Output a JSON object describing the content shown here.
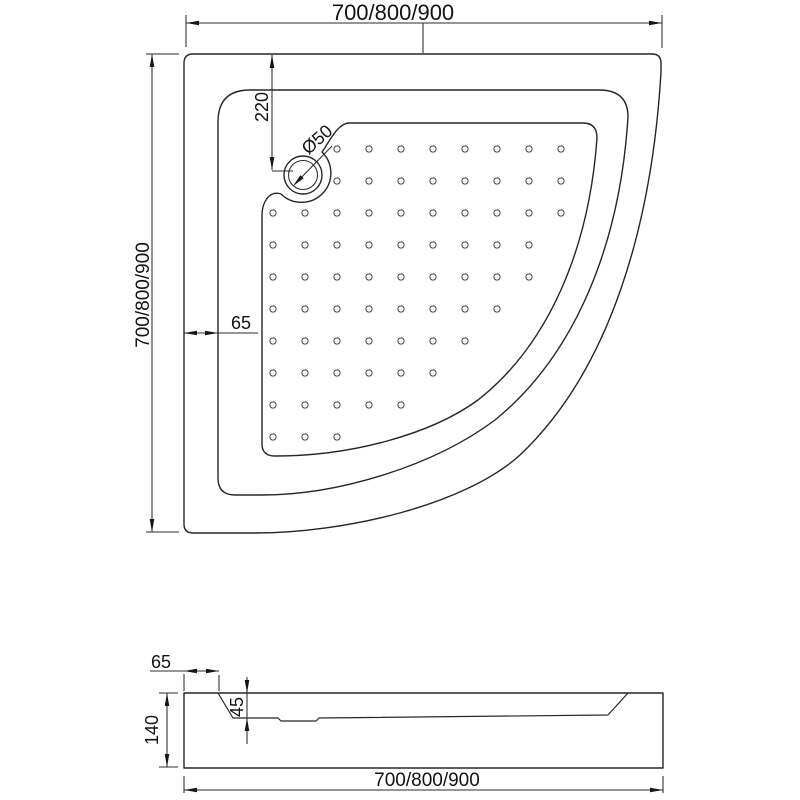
{
  "colors": {
    "line": "#262626",
    "background": "#ffffff"
  },
  "top_view": {
    "width_label": "700/800/900",
    "height_label": "700/800/900",
    "drain_offset_label": "220",
    "drain_diameter_label": "Ø50",
    "rim_width_label": "65"
  },
  "side_view": {
    "rim_width_label": "65",
    "basin_depth_label": "45",
    "height_label": "140",
    "width_label": "700/800/900"
  }
}
